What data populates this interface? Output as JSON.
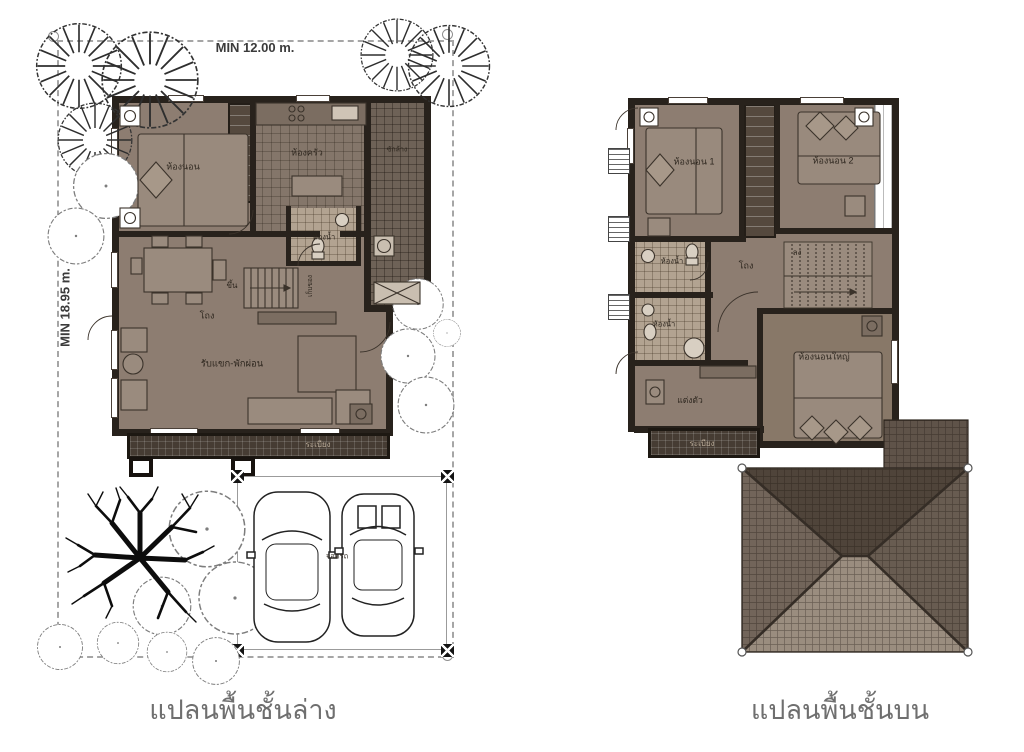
{
  "page": {
    "background": "#ffffff"
  },
  "ground_floor": {
    "caption": "แปลนพื้นชั้นล่าง",
    "dim_width": "MIN 12.00 m.",
    "dim_depth": "MIN 18.95 m.",
    "labels": {
      "bedroom": "ห้องนอน",
      "kitchen": "ห้องครัว",
      "laundry": "ซักล้าง",
      "bathroom": "ห้องน้ำ",
      "stairs_up": "ขึ้น",
      "storage": "เก็บของ",
      "hall": "โถง",
      "living": "รับแขก-พักผ่อน",
      "terrace": "ระเบียง",
      "carport": "จอดรถ"
    }
  },
  "upper_floor": {
    "caption": "แปลนพื้นชั้นบน",
    "labels": {
      "bedroom1": "ห้องนอน 1",
      "bedroom2": "ห้องนอน 2",
      "bathroom1": "ห้องน้ำ",
      "bathroom2": "ห้องน้ำ",
      "hall": "โถง",
      "stairs_down": "ลง",
      "dressing": "แต่งตัว",
      "master_bedroom": "ห้องนอนใหญ่",
      "balcony": "ระเบียง"
    }
  },
  "colors": {
    "room_fill": "#8d7d71",
    "tile_light": "#b2a391",
    "deck": "#463c33",
    "wall": "#28221c",
    "roof_top": "#4f443a",
    "roof_bottom": "#9a8d7f",
    "caption_text": "#6f6f6f",
    "plot_line": "#a6a6a6"
  }
}
